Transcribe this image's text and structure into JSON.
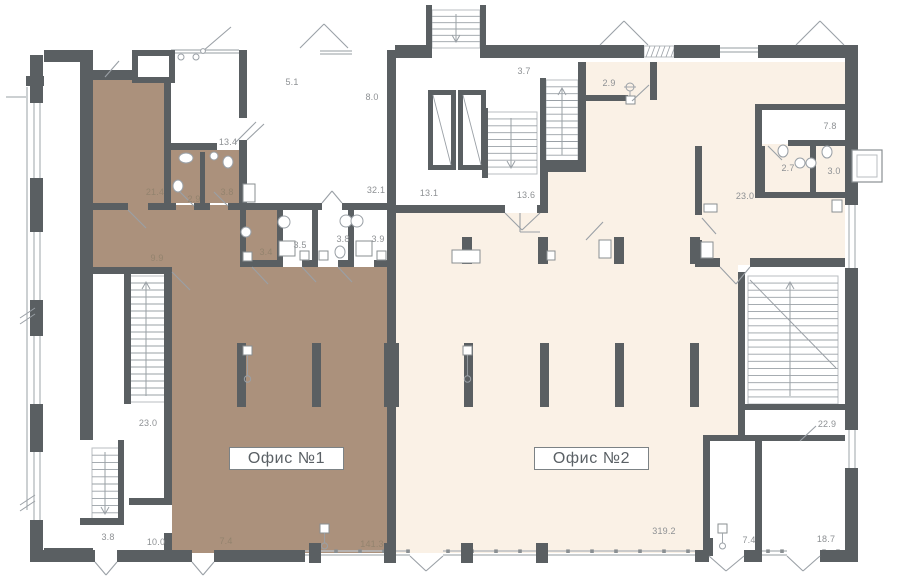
{
  "plan": {
    "office_boxes": [
      {
        "label": "Офис №1"
      },
      {
        "label": "Офис №2"
      }
    ],
    "room_areas": [
      {
        "label": "5.1",
        "x": 292,
        "y": 82,
        "tone": "light"
      },
      {
        "label": "8.0",
        "x": 372,
        "y": 97,
        "tone": "light"
      },
      {
        "label": "3.7",
        "x": 524,
        "y": 71,
        "tone": "light"
      },
      {
        "label": "2.9",
        "x": 609,
        "y": 83,
        "tone": "light"
      },
      {
        "label": "7.8",
        "x": 830,
        "y": 126,
        "tone": "light"
      },
      {
        "label": "13.4",
        "x": 228,
        "y": 142,
        "tone": "light"
      },
      {
        "label": "21.4",
        "x": 155,
        "y": 192,
        "tone": "brown"
      },
      {
        "label": "2.9",
        "x": 194,
        "y": 199,
        "tone": "brown"
      },
      {
        "label": "3.8",
        "x": 227,
        "y": 192,
        "tone": "brown"
      },
      {
        "label": "2.7",
        "x": 788,
        "y": 168,
        "tone": "light"
      },
      {
        "label": "3.0",
        "x": 834,
        "y": 171,
        "tone": "light"
      },
      {
        "label": "32.1",
        "x": 376,
        "y": 190,
        "tone": "light"
      },
      {
        "label": "13.1",
        "x": 429,
        "y": 193,
        "tone": "light"
      },
      {
        "label": "13.6",
        "x": 526,
        "y": 195,
        "tone": "light"
      },
      {
        "label": "23.0",
        "x": 745,
        "y": 196,
        "tone": "light"
      },
      {
        "label": "9.9",
        "x": 157,
        "y": 258,
        "tone": "brown"
      },
      {
        "label": "3.4",
        "x": 266,
        "y": 252,
        "tone": "brown"
      },
      {
        "label": "3.5",
        "x": 300,
        "y": 245,
        "tone": "light"
      },
      {
        "label": "3.8",
        "x": 343,
        "y": 239,
        "tone": "light"
      },
      {
        "label": "3.9",
        "x": 378,
        "y": 239,
        "tone": "light"
      },
      {
        "label": "23.0",
        "x": 148,
        "y": 423,
        "tone": "light"
      },
      {
        "label": "22.9",
        "x": 827,
        "y": 424,
        "tone": "light"
      },
      {
        "label": "3.8",
        "x": 108,
        "y": 537,
        "tone": "light"
      },
      {
        "label": "10.0",
        "x": 156,
        "y": 542,
        "tone": "light"
      },
      {
        "label": "7.4",
        "x": 226,
        "y": 541,
        "tone": "brown"
      },
      {
        "label": "141.3",
        "x": 372,
        "y": 544,
        "tone": "brown"
      },
      {
        "label": "319.2",
        "x": 664,
        "y": 531,
        "tone": "light"
      },
      {
        "label": "7.4",
        "x": 749,
        "y": 540,
        "tone": "light"
      },
      {
        "label": "18.7",
        "x": 826,
        "y": 539,
        "tone": "light"
      }
    ],
    "colors": {
      "wall": "#5a5f62",
      "office1_fill": "#ab917c",
      "office2_fill": "#faf1e6",
      "white": "#ffffff",
      "thin_line": "#9aa0a6",
      "window_line": "#b9bec1",
      "tick": "#8a8f92",
      "label_light": "#8e9194",
      "label_brown": "#93836e",
      "office_text": "#5a6065",
      "office_border": "#7c8285"
    }
  }
}
